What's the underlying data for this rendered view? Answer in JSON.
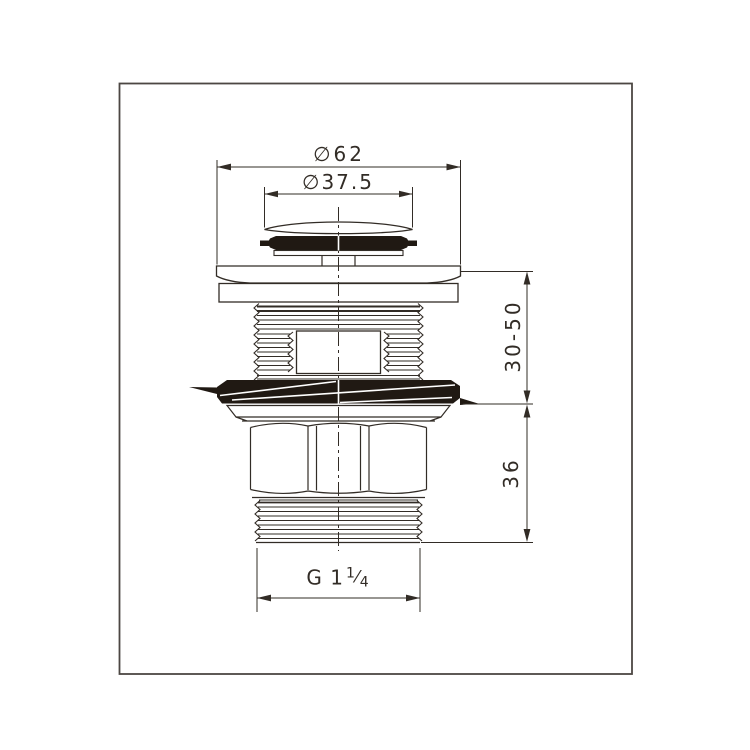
{
  "page": {
    "background": "#ffffff",
    "ink_color": "#322c26",
    "frame_color": "#4c4743",
    "seal_fill": "#201913"
  },
  "drawing": {
    "type": "technical-drawing",
    "dimensions": [
      {
        "label": "∅62"
      },
      {
        "label": "∅37.5"
      },
      {
        "label": "30-50"
      },
      {
        "label": "36"
      },
      {
        "prefix": "G 1",
        "fraction_numerator": "1",
        "fraction_slash": "⁄",
        "fraction_denominator": "4"
      }
    ]
  }
}
